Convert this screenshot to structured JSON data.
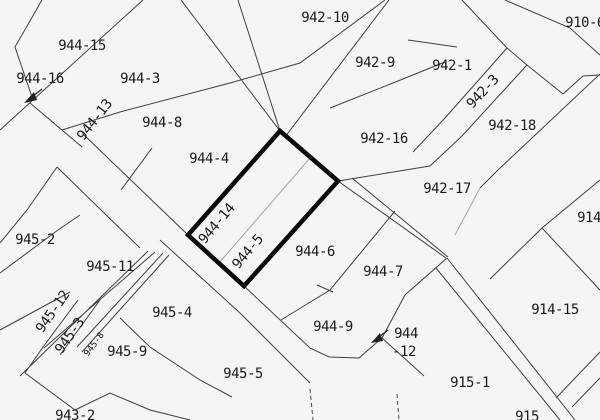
{
  "map": {
    "type": "cadastral-parcel-map",
    "colors": {
      "paper": "#f5f5f2",
      "boundary": "#3f3f3f",
      "faint_boundary": "#a5a5a5",
      "highlight_outline": "#0a0a0a",
      "label_text": "#1b1b1b"
    },
    "selected_parcel": {
      "labels": [
        "944-14",
        "944-5"
      ],
      "outline_points": "280,131 338,181 244,286 188,235"
    },
    "labels": [
      {
        "text": "942-10",
        "x": 325,
        "y": 18,
        "rot": 0
      },
      {
        "text": "910-6",
        "x": 585,
        "y": 23,
        "rot": 0
      },
      {
        "text": "944-15",
        "x": 82,
        "y": 46,
        "rot": 0
      },
      {
        "text": "944-16",
        "x": 40,
        "y": 79,
        "rot": 0
      },
      {
        "text": "944-3",
        "x": 140,
        "y": 79,
        "rot": 0
      },
      {
        "text": "942-9",
        "x": 375,
        "y": 63,
        "rot": 0
      },
      {
        "text": "942-1",
        "x": 452,
        "y": 66,
        "rot": 0
      },
      {
        "text": "942-3",
        "x": 483,
        "y": 92,
        "rot": -47
      },
      {
        "text": "944-13",
        "x": 95,
        "y": 120,
        "rot": -52
      },
      {
        "text": "944-8",
        "x": 162,
        "y": 123,
        "rot": 0
      },
      {
        "text": "942-18",
        "x": 512,
        "y": 126,
        "rot": 0
      },
      {
        "text": "942-16",
        "x": 384,
        "y": 139,
        "rot": 0
      },
      {
        "text": "944-4",
        "x": 209,
        "y": 159,
        "rot": 0
      },
      {
        "text": "942-17",
        "x": 447,
        "y": 189,
        "rot": 0
      },
      {
        "text": "914",
        "x": 589,
        "y": 218,
        "rot": 0
      },
      {
        "text": "945-2",
        "x": 35,
        "y": 240,
        "rot": 0
      },
      {
        "text": "944-14",
        "x": 217,
        "y": 224,
        "rot": -50
      },
      {
        "text": "944-5",
        "x": 248,
        "y": 252,
        "rot": -50
      },
      {
        "text": "944-6",
        "x": 315,
        "y": 252,
        "rot": 0
      },
      {
        "text": "945-11",
        "x": 110,
        "y": 267,
        "rot": 0
      },
      {
        "text": "944-7",
        "x": 383,
        "y": 272,
        "rot": 0
      },
      {
        "text": "945-12",
        "x": 53,
        "y": 312,
        "rot": -55
      },
      {
        "text": "914-15",
        "x": 555,
        "y": 310,
        "rot": 0
      },
      {
        "text": "945-4",
        "x": 172,
        "y": 313,
        "rot": 0
      },
      {
        "text": "945-3",
        "x": 70,
        "y": 336,
        "rot": -55
      },
      {
        "text": "945-8",
        "x": 95,
        "y": 345,
        "rot": -53,
        "small": true
      },
      {
        "text": "944-9",
        "x": 333,
        "y": 327,
        "rot": 0
      },
      {
        "text": "944",
        "x": 406,
        "y": 334,
        "rot": 0
      },
      {
        "text": "-12",
        "x": 404,
        "y": 352,
        "rot": 0
      },
      {
        "text": "945-9",
        "x": 127,
        "y": 352,
        "rot": 0
      },
      {
        "text": "945-5",
        "x": 243,
        "y": 374,
        "rot": 0
      },
      {
        "text": "915-1",
        "x": 470,
        "y": 383,
        "rot": 0
      },
      {
        "text": "943-2",
        "x": 75,
        "y": 416,
        "rot": 0
      },
      {
        "text": "915",
        "x": 527,
        "y": 417,
        "rot": 0
      }
    ]
  }
}
